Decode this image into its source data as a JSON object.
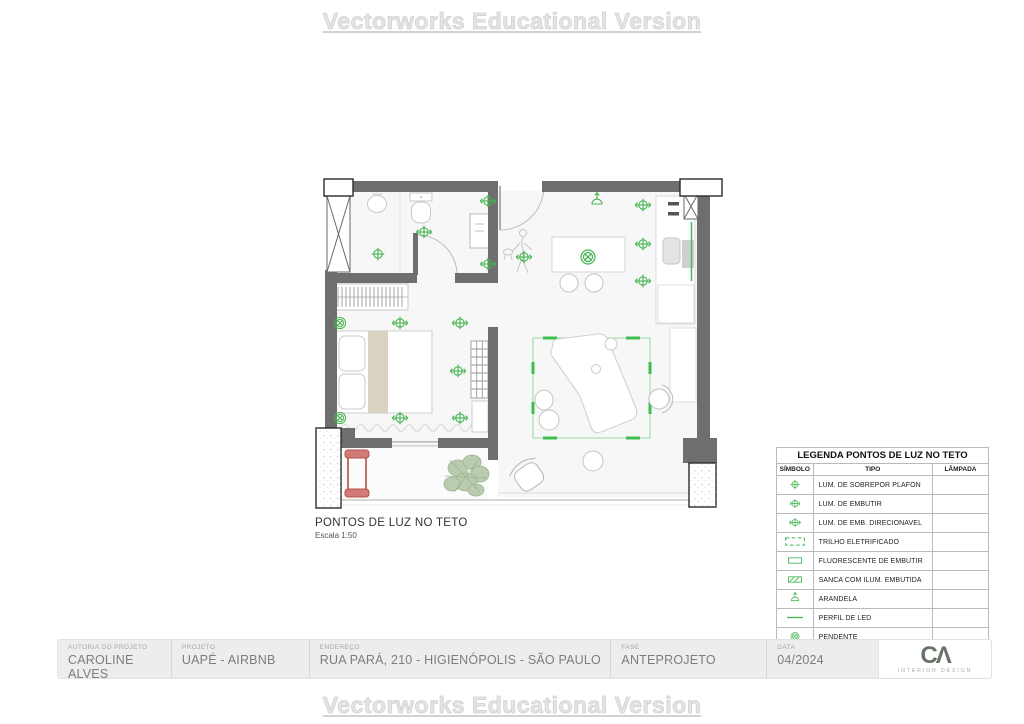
{
  "watermark": {
    "top": "Vectorworks Educational Version",
    "bottom": "Vectorworks Educational Version"
  },
  "plan": {
    "title": "PONTOS DE LUZ NO TETO",
    "scale": "Escala 1:50",
    "colors": {
      "wall": "#6e6e6e",
      "symbol_green": "#45b551",
      "trilho_green": "#4fbf5a",
      "accent_red": "#c0504d",
      "bed_beige": "#d9d2c2",
      "plant_green": "#a3b998"
    },
    "lights": [
      {
        "x": 378,
        "y": 254,
        "t": "embutir"
      },
      {
        "x": 424,
        "y": 232,
        "t": "direcionavel"
      },
      {
        "x": 488,
        "y": 201,
        "t": "direcionavel"
      },
      {
        "x": 488,
        "y": 264,
        "t": "direcionavel"
      },
      {
        "x": 524,
        "y": 257,
        "t": "direcionavel"
      },
      {
        "x": 597,
        "y": 201,
        "t": "arandela"
      },
      {
        "x": 643,
        "y": 205,
        "t": "direcionavel"
      },
      {
        "x": 643,
        "y": 244,
        "t": "direcionavel"
      },
      {
        "x": 643,
        "y": 281,
        "t": "direcionavel"
      },
      {
        "x": 588,
        "y": 257,
        "t": "pendente"
      },
      {
        "x": 340,
        "y": 323,
        "t": "pendente"
      },
      {
        "x": 400,
        "y": 323,
        "t": "direcionavel"
      },
      {
        "x": 460,
        "y": 323,
        "t": "direcionavel"
      },
      {
        "x": 458,
        "y": 371,
        "t": "direcionavel"
      },
      {
        "x": 340,
        "y": 418,
        "t": "pendente"
      },
      {
        "x": 400,
        "y": 418,
        "t": "direcionavel"
      },
      {
        "x": 460,
        "y": 418,
        "t": "direcionavel"
      }
    ]
  },
  "legend": {
    "title": "LEGENDA PONTOS DE LUZ NO TETO",
    "columns": [
      "SÍMBOLO",
      "TIPO",
      "LÂMPADA"
    ],
    "rows": [
      {
        "symbol": "embutir",
        "tipo": "LUM. DE SOBREPOR PLAFON",
        "lampada": ""
      },
      {
        "symbol": "embutir2",
        "tipo": "LUM. DE EMBUTIR",
        "lampada": ""
      },
      {
        "symbol": "direcionavel",
        "tipo": "LUM. DE EMB. DIRECIONAVEL",
        "lampada": ""
      },
      {
        "symbol": "trilho",
        "tipo": "TRILHO ELETRIFICADO",
        "lampada": ""
      },
      {
        "symbol": "fluorescente",
        "tipo": "FLUORESCENTE DE EMBUTIR",
        "lampada": ""
      },
      {
        "symbol": "sanca",
        "tipo": "SANCA COM ILUM. EMBUTIDA",
        "lampada": ""
      },
      {
        "symbol": "arandela",
        "tipo": "ARANDELA",
        "lampada": ""
      },
      {
        "symbol": "perfil-led",
        "tipo": "PERFIL DE LED",
        "lampada": ""
      },
      {
        "symbol": "pendente",
        "tipo": "PENDENTE",
        "lampada": ""
      }
    ]
  },
  "title_block": {
    "fields": [
      {
        "label": "AUTORIA DO PROJETO",
        "value": "CAROLINE ALVES"
      },
      {
        "label": "PROJETO",
        "value": "UAPÉ - AIRBNB"
      },
      {
        "label": "ENDEREÇO",
        "value": "RUA PARÁ, 210 - HIGIENÓPOLIS - SÃO PAULO"
      },
      {
        "label": "FASE",
        "value": "ANTEPROJETO"
      },
      {
        "label": "DATA",
        "value": "04/2024"
      }
    ],
    "logo": {
      "text": "CΛ",
      "subtext": "INTERIOR DESIGN"
    }
  }
}
